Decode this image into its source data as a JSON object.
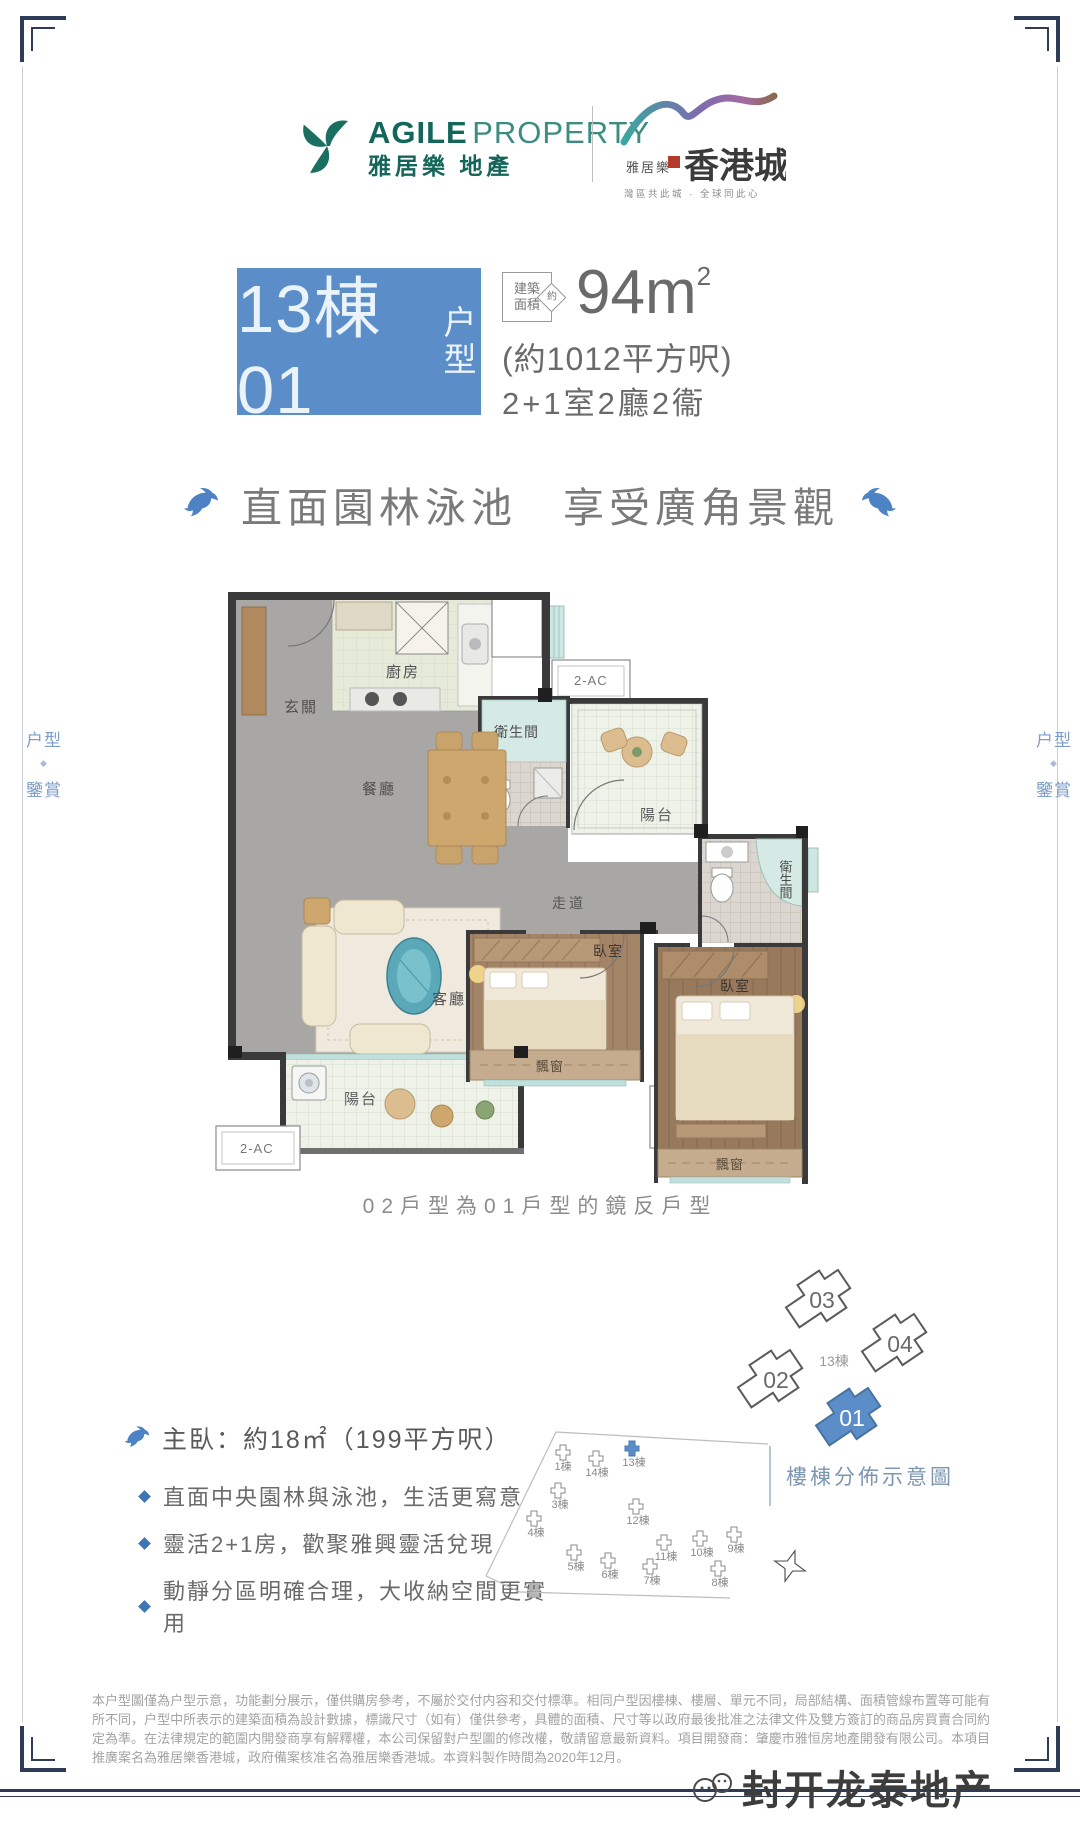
{
  "page": {
    "side_label_top": "户型",
    "side_label_mark": "◆",
    "side_label_bottom": "鑒賞"
  },
  "header": {
    "agile": {
      "en_bold": "AGILE",
      "en_light": "PROPERTY",
      "zh": "雅居樂 地產"
    },
    "hkcity": {
      "small": "雅居樂",
      "big": "香港城",
      "tagline": "灣區共此城 · 全球同此心"
    }
  },
  "title": {
    "block_main": "13棟01",
    "block_sub": "户型",
    "badge_line1": "建築",
    "badge_line2": "面積",
    "badge_approx": "約",
    "area_value": "94m",
    "area_sup": "2",
    "area_paren": "(約1012平方呎)",
    "spec": "2+1室2廳2衞"
  },
  "slogan": {
    "text": "直面園林泳池　享受廣角景觀"
  },
  "floorplan": {
    "caption": "02戶型為01戶型的鏡反戶型",
    "rooms": {
      "foyer": "玄關",
      "kitchen": "廚房",
      "dining": "餐廳",
      "bath": "衛生間",
      "balcony": "陽台",
      "corridor": "走道",
      "living": "客廳",
      "bedroom": "臥室",
      "bay": "飄窗",
      "ac": "2-AC"
    }
  },
  "cluster": {
    "building": "13棟",
    "units": [
      "03",
      "04",
      "02",
      "01"
    ]
  },
  "features": {
    "headline": "主臥：約18㎡（199平方呎）",
    "bullets": [
      "直面中央園林與泳池，生活更寫意",
      "靈活2+1房，歡聚雅興靈活兌現",
      "動靜分區明確合理，大收納空間更實用"
    ]
  },
  "siteplan": {
    "title": "樓棟分佈示意圖",
    "buildings": [
      "1棟",
      "14棟",
      "13棟",
      "3棟",
      "4棟",
      "12棟",
      "11棟",
      "10棟",
      "9棟",
      "5棟",
      "6棟",
      "7棟",
      "8棟"
    ]
  },
  "disclaimer": {
    "text": "本户型圖僅為户型示意，功能劃分展示，僅供購房參考，不屬於交付内容和交付標準。相同户型因樓棟、樓層、單元不同，局部結構、面積管線布置等可能有所不同，户型中所表示的建築面積為設計數據，標識尺寸（如有）僅供參考，具體的面積、尺寸等以政府最後批准之法律文件及雙方簽訂的商品房買賣合同約定為準。在法律規定的範圍内開發商享有解釋權，本公司保留對户型圖的修改權，敬請留意最新資料。項目開發商：肇慶市雅恒房地產開發有限公司。本項目推廣案名為雅居樂香港城，政府備案核准名為雅居樂香港城。本資料製作時間為2020年12月。"
  },
  "watermark": {
    "text": "封开龙泰地产"
  },
  "colors": {
    "accent": "#5b8ec9",
    "frame": "#2f3c58",
    "dolphin": "#4d82c4",
    "agile_green": "#14665a"
  }
}
